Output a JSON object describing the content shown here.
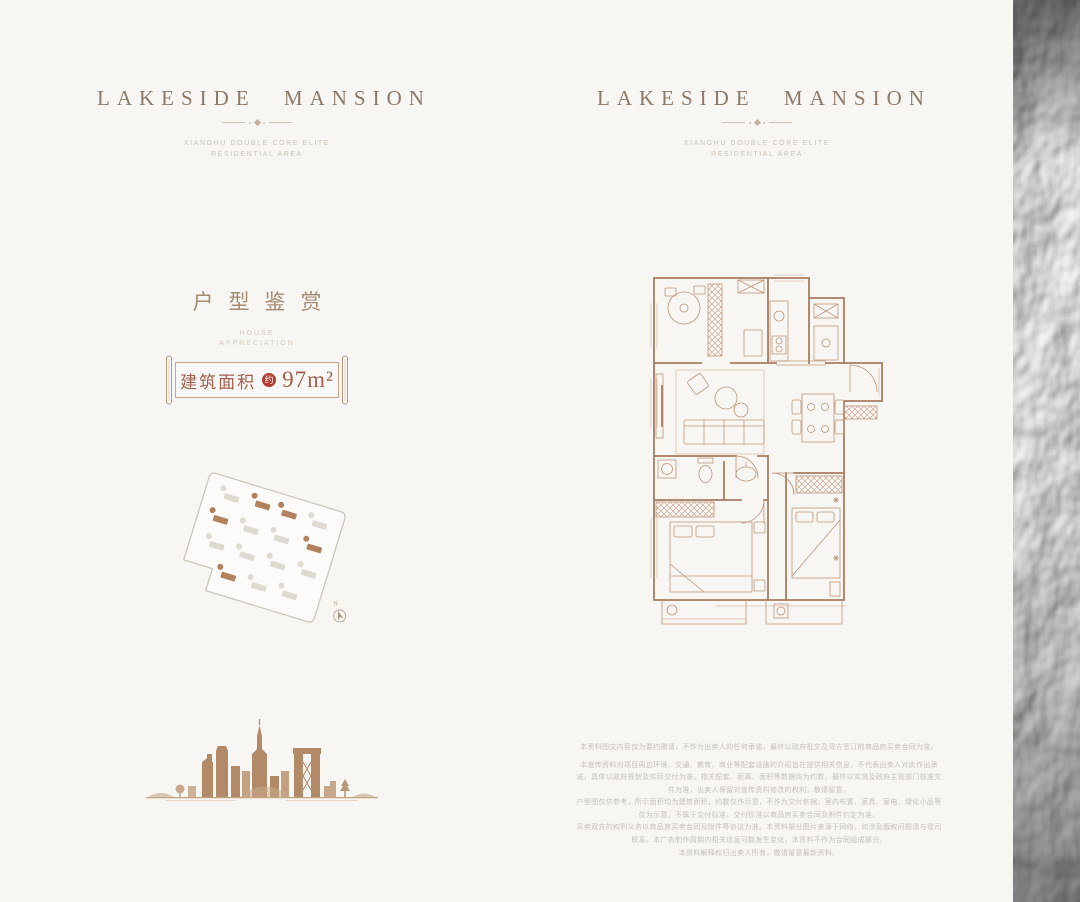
{
  "page": {
    "background": "#f7f6f3",
    "colors": {
      "brand_brown": "#8d7968",
      "accent_red": "#b23a30",
      "banner_text": "#a3604c",
      "plan_line": "#bb9277",
      "skyline_brown": "#b28a68",
      "site_highlight": "#b2825f"
    }
  },
  "brand": {
    "title": "LAKESIDE MANSION",
    "subtitle_line1": "XIANGHU DOUBLE CORE ELITE",
    "subtitle_line2": "RESIDENTIAL AREA"
  },
  "left_panel": {
    "section_title": "户型鉴赏",
    "section_subtitle_line1": "HOUSE",
    "section_subtitle_line2": "APPRECIATION",
    "area_banner": {
      "label": "建筑面积",
      "qualifier": "约",
      "value": "97m²"
    },
    "site_plan": {
      "compass_label": "N"
    }
  },
  "right_panel": {
    "disclaimer_lines": [
      "本资料图文内容仅为要约邀请，不作为出卖人的任何承诺，最终以政府批文及双方签订的商品房买卖合同为准。",
      "本宣传资料对项目周边环境、交通、教育、商业等配套设施的介绍旨在提供相关信息，不代表出卖人对此作出承诺，具体以政府规划及实际交付为准。相关配套、距离、面积等数据均为约数，最终以实测及政府主管部门核准文件为准，出卖人保留对宣传资料修改的权利，敬请留意。",
      "户型图仅供参考，所示面积均为建筑面积，约数仅作示意，不作为交付依据。室内布置、家具、家电、绿化小品等仅为示意，不属于交付标准，交付标准以商品房买卖合同及附件约定为准。",
      "买卖双方的权利义务以商品房买卖合同及附件等协议为准。本资料部分图片来源于网络，如涉及版权问题请与我司联系。本广告制作周期内相关信息可能发生变化，本资料不作为合同组成部分。",
      "本资料解释权归出卖人所有，敬请留意最新资料。"
    ]
  }
}
